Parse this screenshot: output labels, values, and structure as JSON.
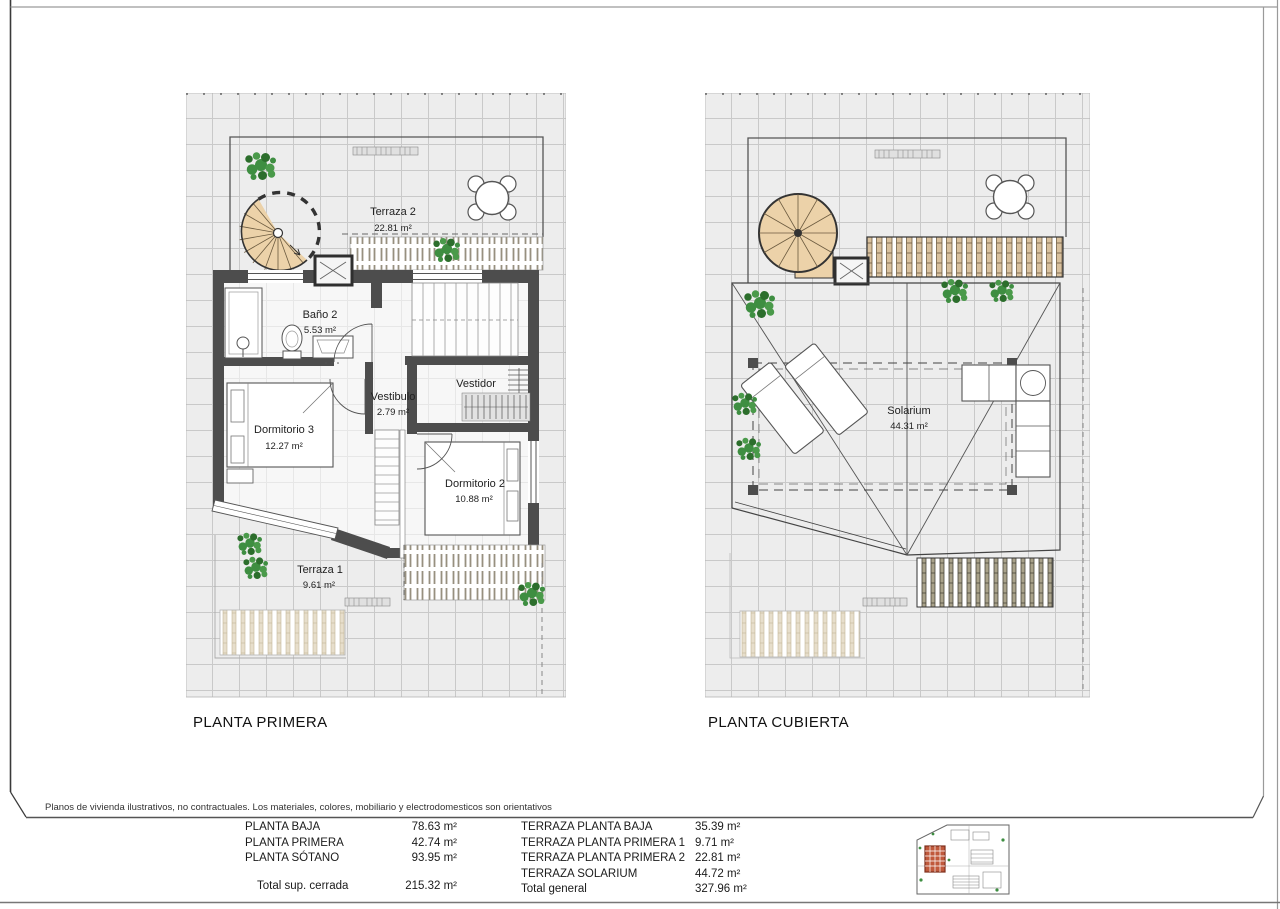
{
  "page": {
    "disclaimer": "Planos de vivienda ilustrativos, no contractuales. Los materiales, colores, mobiliario y electrodomesticos son orientativos"
  },
  "plans": {
    "left": {
      "title": "PLANTA PRIMERA",
      "rooms": {
        "terraza2": {
          "name": "Terraza 2",
          "area": "22.81 m²"
        },
        "bano2": {
          "name": "Baño 2",
          "area": "5.53 m²"
        },
        "dormitorio3": {
          "name": "Dormitorio 3",
          "area": "12.27 m²"
        },
        "vestibulo": {
          "name": "Vestibulo",
          "area": "2.79 m²"
        },
        "vestidor": {
          "name": "Vestidor"
        },
        "dormitorio2": {
          "name": "Dormitorio 2",
          "area": "10.88 m²"
        },
        "terraza1": {
          "name": "Terraza 1",
          "area": "9.61 m²"
        }
      }
    },
    "right": {
      "title": "PLANTA CUBIERTA",
      "rooms": {
        "solarium": {
          "name": "Solarium",
          "area": "44.31 m²"
        }
      }
    }
  },
  "summary": {
    "left_rows": [
      {
        "label": "PLANTA BAJA",
        "value": "78.63 m²"
      },
      {
        "label": "PLANTA PRIMERA",
        "value": "42.74 m²"
      },
      {
        "label": "PLANTA SÓTANO",
        "value": "93.95 m²"
      }
    ],
    "left_total": {
      "label": "Total sup. cerrada",
      "value": "215.32 m²"
    },
    "right_rows": [
      {
        "label": "TERRAZA PLANTA BAJA",
        "value": "35.39 m²"
      },
      {
        "label": "TERRAZA PLANTA PRIMERA 1",
        "value": "9.71 m²"
      },
      {
        "label": "TERRAZA PLANTA PRIMERA 2",
        "value": "22.81 m²"
      },
      {
        "label": "TERRAZA SOLARIUM",
        "value": "44.72 m²"
      }
    ],
    "right_total": {
      "label": "Total general",
      "value": "327.96 m²"
    }
  },
  "colors": {
    "wall": "#4d4d4d",
    "stair_tan": "#ecd2a9",
    "plant_green": "#3e8e41",
    "grid_line": "#c9c9c9",
    "unit_highlight_red": "#b14a30"
  }
}
